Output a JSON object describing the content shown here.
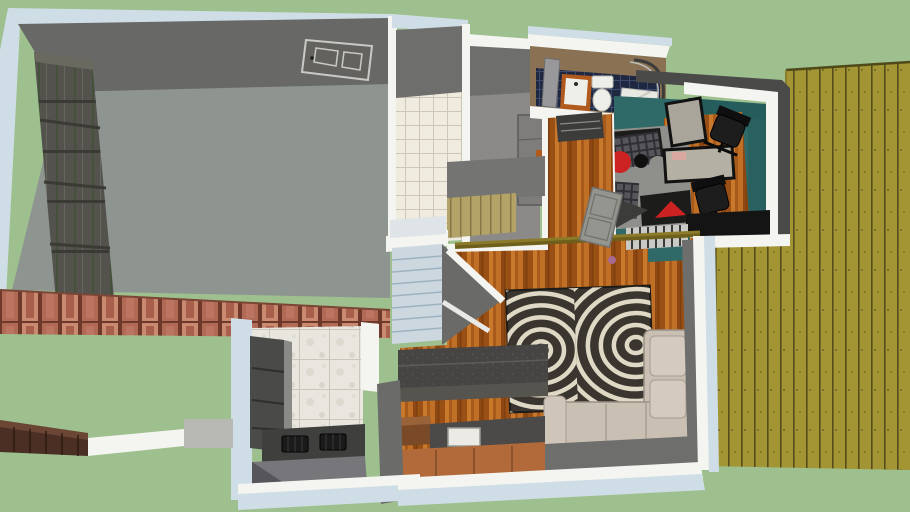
{
  "scene": {
    "title": "overhead-3d-house-floorplan-render",
    "view": "top-down cutaway 3d model",
    "regions": [
      {
        "id": "lawn",
        "label": "lawn"
      },
      {
        "id": "deck-right",
        "label": "side deck"
      },
      {
        "id": "garage",
        "label": "garage"
      },
      {
        "id": "entry-tile",
        "label": "tiled entry"
      },
      {
        "id": "closet",
        "label": "closet corridor"
      },
      {
        "id": "bathroom",
        "label": "bathroom"
      },
      {
        "id": "office",
        "label": "office"
      },
      {
        "id": "hallway-living",
        "label": "hall and living room"
      },
      {
        "id": "stairs",
        "label": "staircase"
      },
      {
        "id": "kitchen-counter",
        "label": "kitchen counter"
      },
      {
        "id": "kitchen-nook",
        "label": "kitchen nook"
      },
      {
        "id": "front-brick-wall",
        "label": "brick front wall"
      },
      {
        "id": "retaining-wall",
        "label": "retaining wall"
      },
      {
        "id": "walkway",
        "label": "walkway"
      },
      {
        "id": "concrete-pad",
        "label": "concrete pad"
      }
    ],
    "furniture": [
      {
        "id": "zebra-rug",
        "label": "zebra rug"
      },
      {
        "id": "sectional-sofa",
        "label": "beige sectional sofa"
      },
      {
        "id": "media-bench",
        "label": "dark media bench"
      },
      {
        "id": "toilet",
        "label": "toilet"
      },
      {
        "id": "vanity",
        "label": "orange vanity sink"
      },
      {
        "id": "shower",
        "label": "curved glass shower"
      },
      {
        "id": "office-chair",
        "label": "black office chair"
      },
      {
        "id": "glass-desk",
        "label": "glass desk"
      },
      {
        "id": "office-rug",
        "label": "abstract red black rug"
      },
      {
        "id": "stove",
        "label": "cooktop"
      },
      {
        "id": "sink",
        "label": "kitchen sink"
      },
      {
        "id": "garage-door",
        "label": "paneled garage door"
      },
      {
        "id": "flat-door",
        "label": "panel door on wall"
      },
      {
        "id": "dresser",
        "label": "hall dresser"
      },
      {
        "id": "tall-cabinet",
        "label": "closet cabinet"
      }
    ]
  },
  "colors": {
    "grass": "#9ec08f",
    "deck_base": "#a39434",
    "deck_line": "#554e1c",
    "wall_blue": "#cfdde6",
    "wall_white": "#f4f4f0",
    "wall_dark": "#6e6e6c",
    "wall_darker": "#4a4a48",
    "garage_floor": "#8e9590",
    "garage_door": "#53524c",
    "door_slit_green": "#45523b",
    "entry_tile": "#efebdf",
    "tile_line": "#cdc6b6",
    "closet_floor": "#8b8a88",
    "bath_wall": "#8a7154",
    "bath_floor": "#1f2840",
    "bath_tile_line": "#3c4a6e",
    "vanity_orange": "#b05a1e",
    "porcelain": "#efefe9",
    "office_floor": "#2f6a68",
    "office_wall": "#255c5c",
    "wood_base": "#b4631f",
    "rug_dark": "#3a362f",
    "rug_stripe": "#ded8c4",
    "sofa_beige": "#c9bfb2",
    "sofa_shadow": "#a99e92",
    "bench_gray": "#474543",
    "counter_dark": "#4c4a48",
    "cabinet_orange": "#b26a3a",
    "marble": "#e8e6de",
    "brick": "#b06a55",
    "brick_gap": "#6e392a",
    "fence_brown": "#4b2f24",
    "stairs_light": "#ccd7e0",
    "rail_olive": "#8a7a2a",
    "accent_red": "#cc2222",
    "chair_black": "#1d1d1d",
    "concrete": "#b9b9b3"
  }
}
